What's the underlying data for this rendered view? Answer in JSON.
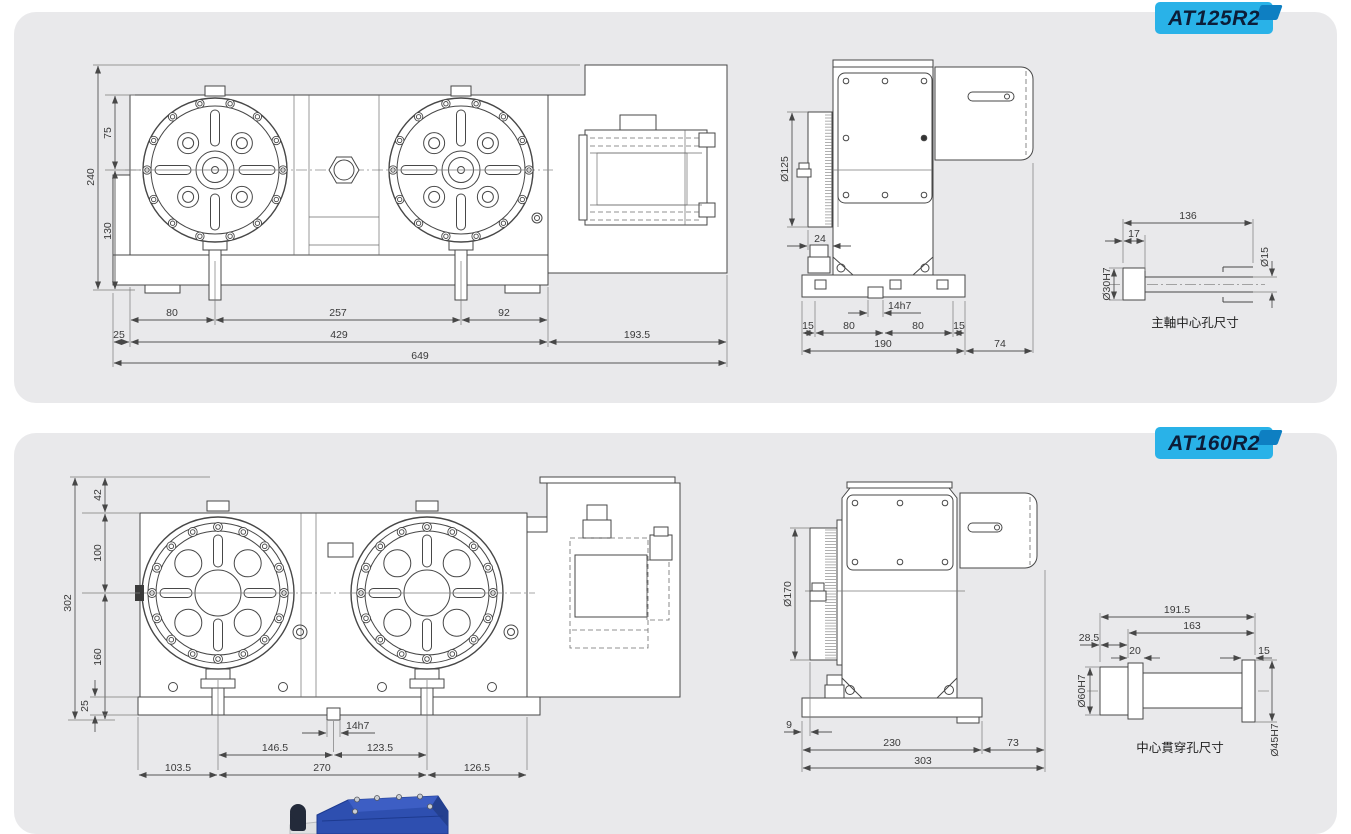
{
  "colors": {
    "panel_bg": "#e9e9eb",
    "badge_bg": "#29b2e8",
    "badge_fold": "#0e7fc2",
    "badge_text": "#0c1d38",
    "line": "#474747",
    "photo_blue": "#2e4fb0"
  },
  "panels": [
    {
      "badge": "AT125R2",
      "front": {
        "h_total": "240",
        "h_top": "75",
        "h_bottom": "130",
        "w_offset": "25",
        "w_edge_to_c1": "80",
        "w_c1_to_c2": "257",
        "w_c2_to_edge": "92",
        "w_body": "429",
        "w_motor": "193.5",
        "w_total": "649"
      },
      "side": {
        "dia": "Ø125",
        "offset": "24",
        "key": "14h7",
        "b1": "15",
        "b2": "80",
        "b3": "80",
        "b4": "15",
        "base": "190",
        "motor_ext": "74"
      },
      "detail": {
        "len_total": "136",
        "len_head": "17",
        "bore": "Ø30H7",
        "tip": "Ø15",
        "caption": "主軸中心孔尺寸"
      }
    },
    {
      "badge": "AT160R2",
      "front": {
        "h_total": "302",
        "h_top": "42",
        "h_mid": "100",
        "h_bottom": "160",
        "h_base": "25",
        "key": "14h7",
        "w_c1_to_key": "146.5",
        "w_key_to_c2": "123.5",
        "w_left": "103.5",
        "w_centers": "270",
        "w_right": "126.5"
      },
      "side": {
        "dia": "Ø170",
        "offset": "9",
        "base": "230",
        "motor_ext": "73",
        "total": "303"
      },
      "detail": {
        "len_total": "191.5",
        "len_shaft": "163",
        "len_head": "28.5",
        "len_collar": "20",
        "len_tip": "15",
        "bore": "Ø60H7",
        "tip": "Ø45H7",
        "caption": "中心貫穿孔尺寸"
      }
    }
  ]
}
